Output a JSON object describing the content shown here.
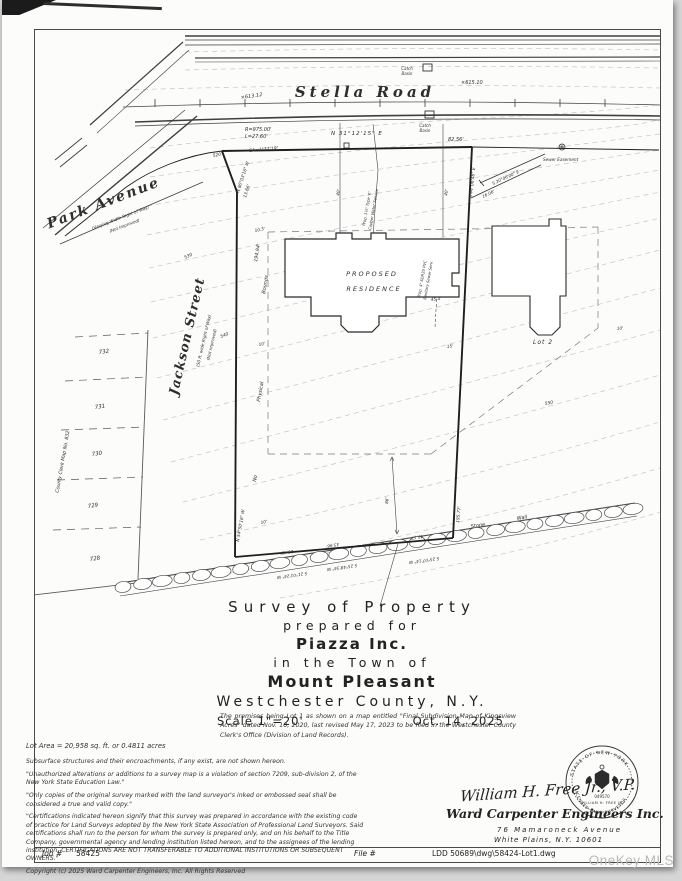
{
  "page": {
    "watermark": "OneKey MLS"
  },
  "title_block": {
    "line1": "Survey  of  Property",
    "line2": "prepared  for",
    "client": "Piazza Inc.",
    "line3": "in  the  Town  of",
    "town": "Mount Pleasant",
    "county": "Westchester  County,   N.Y.",
    "scale": "Scale 1\"=20'",
    "date": "Oct. 14, 2025",
    "premises_note": "The premises being Lot 1 as shown on a map entitled \"Final Subdivision Map of Kingsview Acres\" dated Nov. 10, 2020, last revised May 17, 2023 to be filed in the Westchester County Clerk's Office (Division of Land Records)."
  },
  "notes": {
    "lot_area": "Lot Area = 20,958 sq. ft. or 0.4811 acres",
    "subsurface": "Subsurface structures and their encroachments, if any exist, are not shown hereon.",
    "alterations": "\"Unauthorized alterations or additions to a survey map is a violation of section 7209, sub-division 2, of the New York State Education Law.\"",
    "copies": "\"Only copies of the original survey marked with the land surveyor's inked or embossed seal shall be considered a true and valid copy.\"",
    "certifications": "\"Certifications indicated hereon signify that this survey was prepared in accordance with the existing code of practice for Land Surveys adopted by the New York State Association of Professional Land Surveyors. Said certifications shall run to the person for whom the survey is prepared only, and on his behalf to the Title Company, governmental agency and lending institution listed hereon, and to the assignees of the lending institution. CERTIFICATIONS ARE NOT TRANSFERABLE TO ADDITIONAL INSTITUTIONS OR SUBSEQUENT OWNERS.\"",
    "copyright": "Copyright (c) 2025 Ward Carpenter Engineers, Inc. All Rights Reserved"
  },
  "signature": {
    "name": "William H. Free Jr.,  V.P.",
    "firm": "Ward Carpenter Engineers Inc.",
    "address1": "76  Mamaroneck  Avenue",
    "address2": "White Plains, N.Y.  10601",
    "seal": {
      "top": "STATE OF NEW YORK",
      "name": "WILLIAM H. FREE JR.",
      "bottom": "LICENSED LAND SURVEYOR",
      "number": "049570"
    }
  },
  "footer": {
    "job_label": "Job #",
    "job_number": "58425",
    "file_label": "File #",
    "drawing_file": "LDD 50689\\dwg\\58424-Lot1.dwg"
  },
  "map": {
    "annotations": [
      {
        "t": "Stella  Road",
        "x": 330,
        "y": 67,
        "s": 15,
        "b": 1,
        "i": 1,
        "ls": 4,
        "a": "middle",
        "f": "serif"
      },
      {
        "t": "Park  Avenue",
        "x": 70,
        "y": 177,
        "r": -21,
        "s": 14,
        "b": 1,
        "i": 1,
        "ls": 2,
        "a": "middle",
        "f": "serif"
      },
      {
        "t": "(Varying Width Right of Way)",
        "x": 86,
        "y": 189,
        "r": -21,
        "s": 4.2,
        "i": 1,
        "a": "middle"
      },
      {
        "t": "(Not Improved)",
        "x": 90,
        "y": 197,
        "r": -21,
        "s": 4.2,
        "i": 1,
        "a": "middle"
      },
      {
        "t": "Jackson  Street",
        "x": 156,
        "y": 307,
        "r": -77,
        "s": 13,
        "b": 1,
        "i": 1,
        "ls": 1,
        "a": "middle",
        "f": "serif"
      },
      {
        "t": "(50 ft. wide Right of Way)",
        "x": 170,
        "y": 311,
        "r": -77,
        "s": 4.2,
        "i": 1,
        "a": "middle"
      },
      {
        "t": "(Not Improved)",
        "x": 178,
        "y": 315,
        "r": -77,
        "s": 4.2,
        "i": 1,
        "a": "middle"
      },
      {
        "t": "County Clerk Map No. 832",
        "x": 29,
        "y": 432,
        "r": -80,
        "s": 4.8,
        "i": 1,
        "a": "middle"
      },
      {
        "t": "732",
        "x": 64,
        "y": 324,
        "r": -8,
        "s": 5.5,
        "i": 1
      },
      {
        "t": "731",
        "x": 60,
        "y": 379,
        "r": -8,
        "s": 5.5,
        "i": 1
      },
      {
        "t": "730",
        "x": 57,
        "y": 426,
        "r": -8,
        "s": 5.5,
        "i": 1
      },
      {
        "t": "729",
        "x": 53,
        "y": 478,
        "r": -8,
        "s": 5.5,
        "i": 1
      },
      {
        "t": "728",
        "x": 55,
        "y": 531,
        "r": -8,
        "s": 5.5,
        "i": 1
      },
      {
        "t": "R=975.00'",
        "x": 210,
        "y": 101,
        "s": 5,
        "i": 1
      },
      {
        "t": "L=27.60'",
        "x": 210,
        "y": 108,
        "s": 5,
        "i": 1
      },
      {
        "t": "CA=1°37'19\"",
        "x": 214,
        "y": 122,
        "r": -5,
        "s": 4.5,
        "i": 1
      },
      {
        "t": "N 31°12'15\" E",
        "x": 296,
        "y": 105,
        "s": 5.5,
        "i": 1,
        "ls": 1
      },
      {
        "t": "82.56'",
        "x": 413,
        "y": 111,
        "s": 5,
        "i": 1
      },
      {
        "t": "N 80°03'16\" W",
        "x": 204,
        "y": 163,
        "r": -72,
        "s": 4.4,
        "i": 1
      },
      {
        "t": "13.66'",
        "x": 211,
        "y": 168,
        "r": -72,
        "s": 4.4,
        "i": 1
      },
      {
        "t": "194.94'",
        "x": 222,
        "y": 232,
        "r": -80,
        "s": 4.8,
        "i": 1
      },
      {
        "t": "N 54°50'16\" W",
        "x": 204,
        "y": 512,
        "r": -80,
        "s": 4.4,
        "i": 1
      },
      {
        "t": "S 44°06'46\" E",
        "x": 437,
        "y": 168,
        "r": -84,
        "s": 4.4,
        "i": 1
      },
      {
        "t": "195.77'",
        "x": 424,
        "y": 493,
        "r": -84,
        "s": 4.4,
        "i": 1
      },
      {
        "t": "Bounds",
        "x": 230,
        "y": 264,
        "r": -80,
        "s": 5,
        "i": 1
      },
      {
        "t": "Physical",
        "x": 225,
        "y": 372,
        "r": -80,
        "s": 5,
        "i": 1
      },
      {
        "t": "No",
        "x": 221,
        "y": 452,
        "r": -80,
        "s": 5,
        "i": 1
      },
      {
        "t": "×613.12",
        "x": 206,
        "y": 69,
        "r": -8,
        "s": 5,
        "i": 1
      },
      {
        "t": "×615.10",
        "x": 426,
        "y": 54,
        "s": 5,
        "i": 1
      },
      {
        "t": "520",
        "x": 178,
        "y": 127,
        "r": -10,
        "s": 4.4,
        "i": 1
      },
      {
        "t": "530",
        "x": 150,
        "y": 229,
        "r": -25,
        "s": 4.4,
        "i": 1
      },
      {
        "t": "540",
        "x": 186,
        "y": 308,
        "r": -22,
        "s": 4.4,
        "i": 1
      },
      {
        "t": "550",
        "x": 510,
        "y": 375,
        "r": -10,
        "s": 4.4,
        "i": 1
      },
      {
        "t": "Catch",
        "x": 372,
        "y": 40,
        "s": 4,
        "i": 1,
        "a": "middle"
      },
      {
        "t": "Basin",
        "x": 372,
        "y": 45,
        "s": 4,
        "i": 1,
        "a": "middle"
      },
      {
        "t": "Catch",
        "x": 390,
        "y": 97,
        "s": 4,
        "i": 1,
        "a": "middle"
      },
      {
        "t": "Basin",
        "x": 390,
        "y": 102,
        "s": 4,
        "i": 1,
        "a": "middle"
      },
      {
        "t": "Sewer Easement",
        "x": 508,
        "y": 131,
        "s": 4.2,
        "i": 1
      },
      {
        "t": "S 20°06'00\" E",
        "x": 458,
        "y": 155,
        "r": -25,
        "s": 4.2,
        "i": 1
      },
      {
        "t": "16.06'",
        "x": 448,
        "y": 168,
        "r": -25,
        "s": 4.2,
        "i": 1
      },
      {
        "t": "PROPOSED",
        "x": 337,
        "y": 246,
        "s": 6.5,
        "i": 1,
        "ls": 2,
        "a": "middle"
      },
      {
        "t": "RESIDENCE",
        "x": 339,
        "y": 261,
        "s": 6.5,
        "i": 1,
        "ls": 2,
        "a": "middle"
      },
      {
        "t": "Prop. 1½\" Type 'K'",
        "x": 330,
        "y": 196,
        "r": -80,
        "s": 3.8,
        "i": 1
      },
      {
        "t": "Copper Water Service",
        "x": 336,
        "y": 200,
        "r": -80,
        "s": 3.8,
        "i": 1
      },
      {
        "t": "Prop. 4\" SDR35 PVC",
        "x": 385,
        "y": 268,
        "r": -80,
        "s": 3.8,
        "i": 1
      },
      {
        "t": "Sanitary Sewer Serv.",
        "x": 391,
        "y": 270,
        "r": -80,
        "s": 3.8,
        "i": 1
      },
      {
        "t": "40'",
        "x": 304,
        "y": 166,
        "r": -80,
        "s": 4.2,
        "i": 1
      },
      {
        "t": "40'",
        "x": 412,
        "y": 166,
        "r": -80,
        "s": 4.2,
        "i": 1
      },
      {
        "t": "10.3'",
        "x": 220,
        "y": 202,
        "r": -12,
        "s": 4.2,
        "i": 1
      },
      {
        "t": "45.4'",
        "x": 396,
        "y": 271,
        "r": -6,
        "s": 4.2,
        "i": 1
      },
      {
        "t": "10'",
        "x": 224,
        "y": 316,
        "r": -12,
        "s": 4.2,
        "i": 1
      },
      {
        "t": "15'",
        "x": 412,
        "y": 318,
        "r": -6,
        "s": 4.2,
        "i": 1
      },
      {
        "t": "10'",
        "x": 582,
        "y": 300,
        "r": -6,
        "s": 4.2,
        "i": 1
      },
      {
        "t": "10'",
        "x": 226,
        "y": 494,
        "r": -12,
        "s": 4.2,
        "i": 1
      },
      {
        "t": "86'",
        "x": 353,
        "y": 474,
        "r": -85,
        "s": 4.2,
        "i": 1
      },
      {
        "t": "Lot 2",
        "x": 498,
        "y": 314,
        "s": 6,
        "i": 1,
        "ls": 1
      },
      {
        "t": "Stone",
        "x": 436,
        "y": 498,
        "r": -9,
        "s": 5,
        "i": 1
      },
      {
        "t": "Wall",
        "x": 482,
        "y": 490,
        "r": -9,
        "s": 5,
        "i": 1
      },
      {
        "t": "25.48'",
        "x": 258,
        "y": 520,
        "r": 172,
        "s": 4.2,
        "i": 1
      },
      {
        "t": "S 21°01'24\" W",
        "x": 272,
        "y": 542,
        "r": 172,
        "s": 4.2,
        "i": 1
      },
      {
        "t": "33.96'",
        "x": 304,
        "y": 513,
        "r": 172,
        "s": 4.2,
        "i": 1
      },
      {
        "t": "S 25°48'34\" W",
        "x": 322,
        "y": 534,
        "r": 172,
        "s": 4.2,
        "i": 1
      },
      {
        "t": "43.57'",
        "x": 388,
        "y": 505,
        "r": 172,
        "s": 4.2,
        "i": 1
      },
      {
        "t": "S 25°07'14\" W",
        "x": 404,
        "y": 527,
        "r": 172,
        "s": 4.2,
        "i": 1
      }
    ]
  }
}
